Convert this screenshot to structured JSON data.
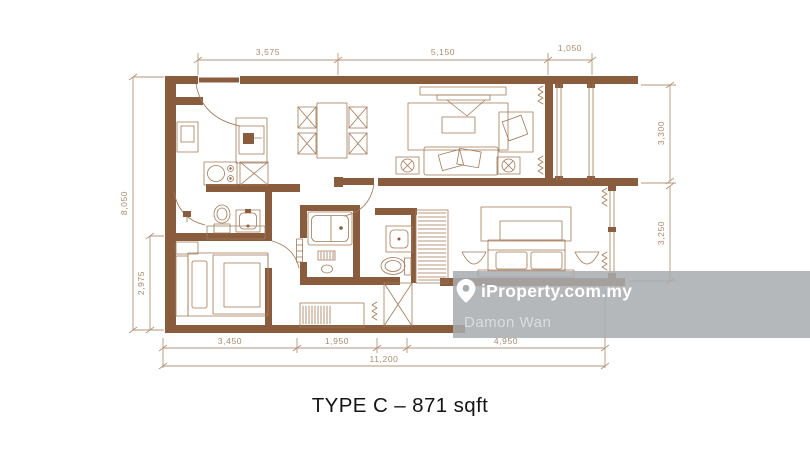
{
  "title": "TYPE C – 871 sqft",
  "watermark": {
    "brand": "iProperty.com.my",
    "agent": "Damon Wan"
  },
  "dimensions": {
    "top": [
      "3,575",
      "5,150",
      "1,050"
    ],
    "left": [
      "8,050",
      "2,975"
    ],
    "right": [
      "3,300",
      "3,250"
    ],
    "bottom": [
      "3,450",
      "1,950",
      "4,950"
    ],
    "total": "11,200"
  },
  "colors": {
    "wall": "#8a5c3e",
    "furniture_line": "#a17a59",
    "dimension": "#ab8a6d",
    "watermark_bg": "#a8acaf",
    "watermark_text": "#ffffff",
    "title_text": "#141414"
  }
}
